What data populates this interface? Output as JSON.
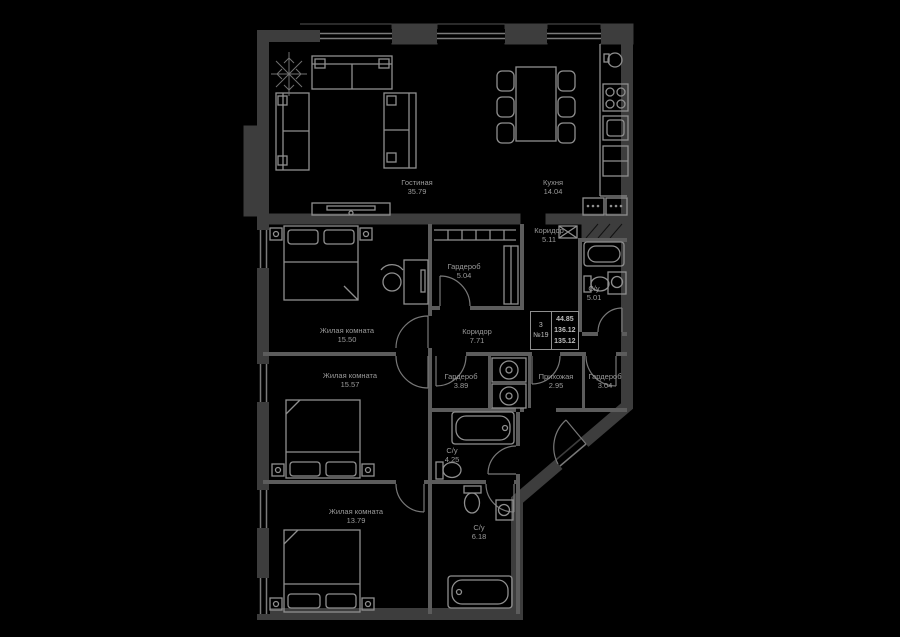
{
  "plan": {
    "rooms": [
      {
        "name": "Гостиная",
        "area": "35.79"
      },
      {
        "name": "Кухня",
        "area": "14.04"
      },
      {
        "name": "Коридор",
        "area": "5.11"
      },
      {
        "name": "Гардероб",
        "area": "5.04"
      },
      {
        "name": "С/у",
        "area": "5.01"
      },
      {
        "name": "Жилая комната",
        "area": "15.50"
      },
      {
        "name": "Коридор",
        "area": "7.71"
      },
      {
        "name": "Жилая комната",
        "area": "15.57"
      },
      {
        "name": "Гардероб",
        "area": "3.89"
      },
      {
        "name": "Прихожая",
        "area": "2.95"
      },
      {
        "name": "Гардероб",
        "area": "3.04"
      },
      {
        "name": "С/у",
        "area": "4.25"
      },
      {
        "name": "Жилая комната",
        "area": "13.79"
      },
      {
        "name": "С/у",
        "area": "6.18"
      }
    ],
    "stamp": {
      "rooms_count": "3",
      "unit_number": "№19",
      "living_area": "44.85",
      "total_area": "136.12",
      "reduced_total_area": "135.12"
    },
    "colors": {
      "background": "#000000",
      "exterior_wall": "#3d3d3d",
      "interior_wall": "#5c5c5c",
      "furniture_line": "#8f8f8f",
      "label_text": "#9a9a9a"
    }
  }
}
